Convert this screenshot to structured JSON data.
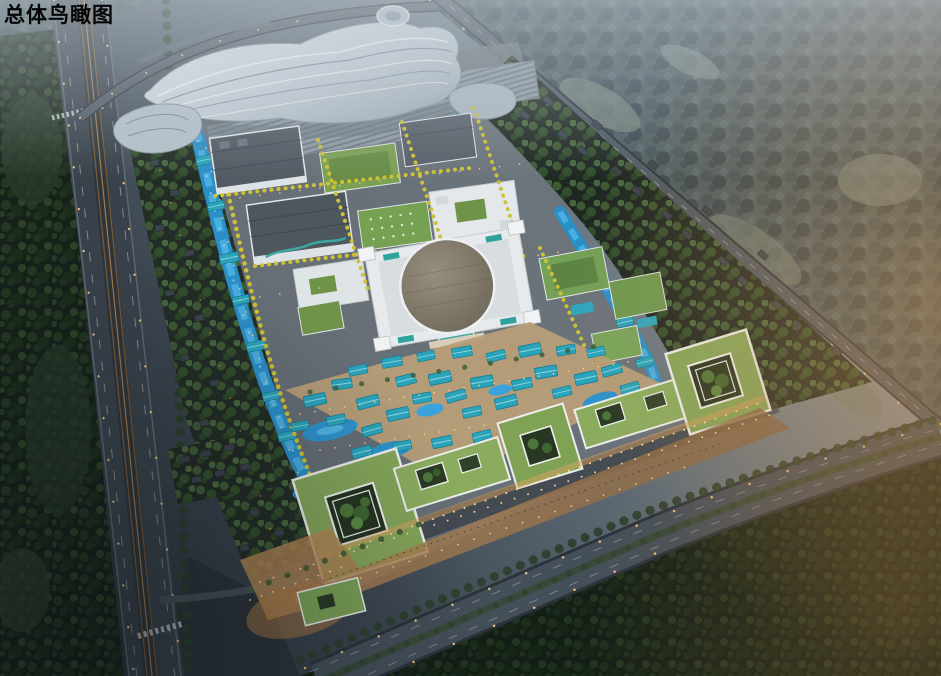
{
  "title": "总体鸟瞰图",
  "palette": {
    "sky_haze": "#a8b4bd",
    "dusk_shadow": "#252d36",
    "forest_dark": "#16211a",
    "forest_mist": "#4c5c60",
    "asphalt": "#4e5862",
    "rail_brown": "#7c5a36",
    "building_white": "#e7eaec",
    "hall_roof_gray": "#525b63",
    "green_roof": "#7ba054",
    "lawn_roof_mall": "#84a65a",
    "dome_roof": "#8d8577",
    "village_roof_teal": "#2ba4bb",
    "water_blue": "#2e93cc",
    "water_bright": "#49aee0",
    "autumn_tree_yellow": "#cdc136",
    "plaza_warm": "#c9935a",
    "street_light": "#ffc87b"
  }
}
